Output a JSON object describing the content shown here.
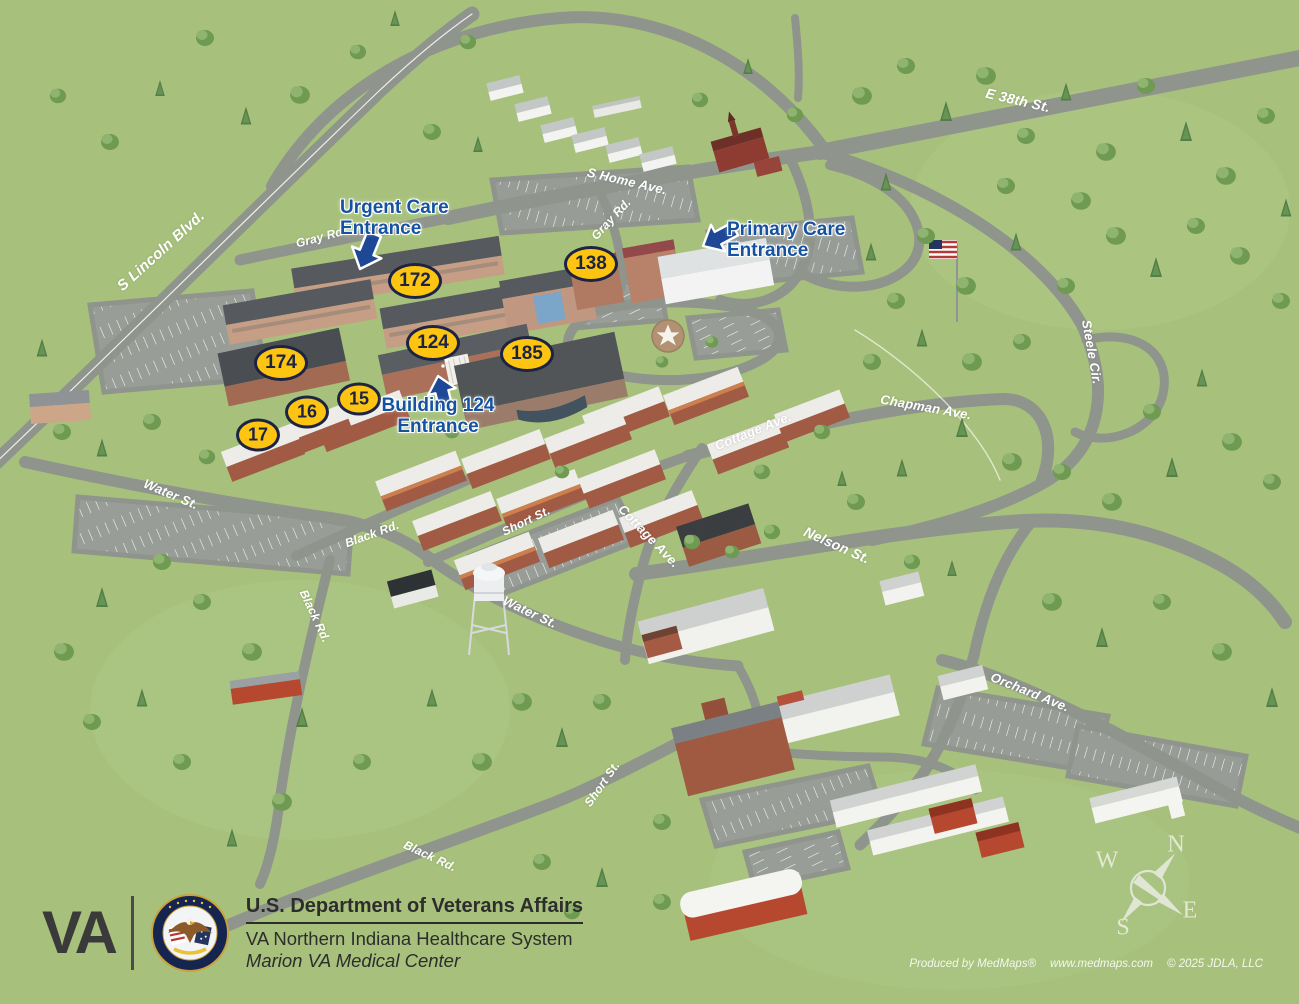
{
  "map_title": "Marion VA Medical Center campus map",
  "road_labels": [
    {
      "text": "S Lincoln Blvd."
    },
    {
      "text": "E 38th St."
    },
    {
      "text": "S Home Ave."
    },
    {
      "text": "Gray Rd."
    },
    {
      "text": "Gray Rd."
    },
    {
      "text": "Steele Cir."
    },
    {
      "text": "Chapman Ave."
    },
    {
      "text": "Cottage Ave."
    },
    {
      "text": "Cottage Ave."
    },
    {
      "text": "Nelson St."
    },
    {
      "text": "Water St."
    },
    {
      "text": "Water St."
    },
    {
      "text": "Short St."
    },
    {
      "text": "Short St."
    },
    {
      "text": "Black Rd."
    },
    {
      "text": "Black Rd."
    },
    {
      "text": "Black Rd."
    },
    {
      "text": "Orchard Ave."
    }
  ],
  "building_badges": [
    {
      "number": "172"
    },
    {
      "number": "138"
    },
    {
      "number": "174"
    },
    {
      "number": "124"
    },
    {
      "number": "185"
    },
    {
      "number": "15"
    },
    {
      "number": "16"
    },
    {
      "number": "17"
    }
  ],
  "entrances": [
    {
      "line1": "Urgent Care",
      "line2": "Entrance"
    },
    {
      "line1": "Primary Care",
      "line2": "Entrance"
    },
    {
      "line1": "Building 124",
      "line2": "Entrance"
    }
  ],
  "compass": {
    "n": "N",
    "e": "E",
    "s": "S",
    "w": "W"
  },
  "footer": {
    "logo": "VA",
    "agency": "U.S. Department of Veterans Affairs",
    "system": "VA Northern Indiana Healthcare System",
    "facility": "Marion VA Medical Center"
  },
  "credits": {
    "produced": "Produced by MedMaps®",
    "url": "www.medmaps.com",
    "copyright": "© 2025 JDLA, LLC"
  },
  "colors": {
    "grass": "#a7c17c",
    "road": "#8f948d",
    "badge_fill": "#fdc511",
    "badge_border": "#1d2342",
    "entrance_blue": "#1553a0"
  }
}
